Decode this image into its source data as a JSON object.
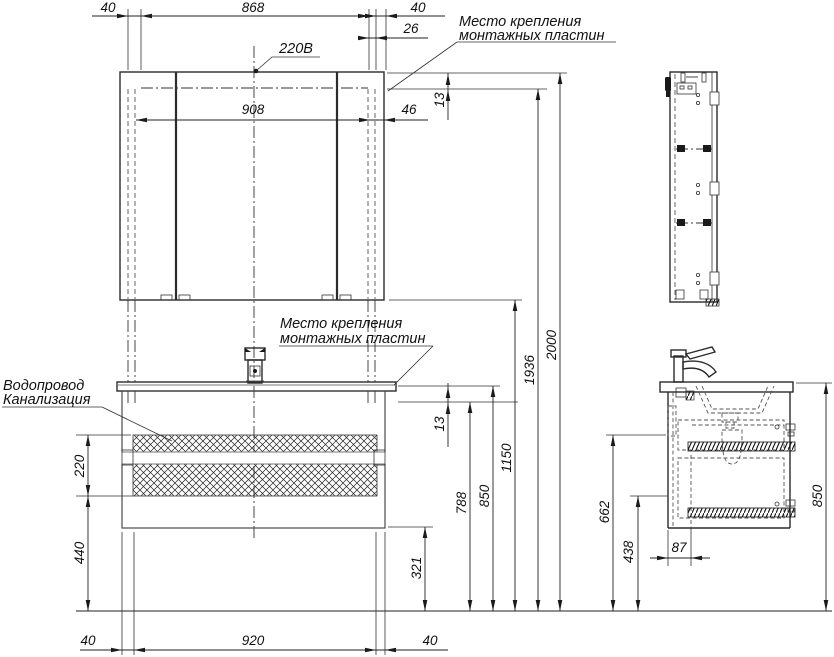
{
  "labels": {
    "power": "220В",
    "mount_top_l1": "Место крепления",
    "mount_top_l2": "монтажных пластин",
    "mount_mid_l1": "Место крепления",
    "mount_mid_l2": "монтажных пластин",
    "water": "Водопровод",
    "sewer": "Канализация"
  },
  "dims": {
    "top_left_offset": "40",
    "top_span": "868",
    "top_right_offset": "40",
    "plate_width": "26",
    "mirror_width": "908",
    "mirror_right_inset": "46",
    "plate_gap_top": "13",
    "height_total": "2000",
    "height_plates": "1936",
    "height_mirror_bottom": "1150",
    "height_vanity_top": "850",
    "height_vanity_plates": "788",
    "plate_gap_mid": "13",
    "height_cabinet_bottom": "321",
    "utility_zone_height": "220",
    "clearance_below": "440",
    "bottom_left_offset": "40",
    "bottom_span": "920",
    "bottom_right_offset": "40",
    "side_utility_height": "662",
    "side_clearance": "438",
    "side_inset": "87",
    "side_height": "850"
  }
}
